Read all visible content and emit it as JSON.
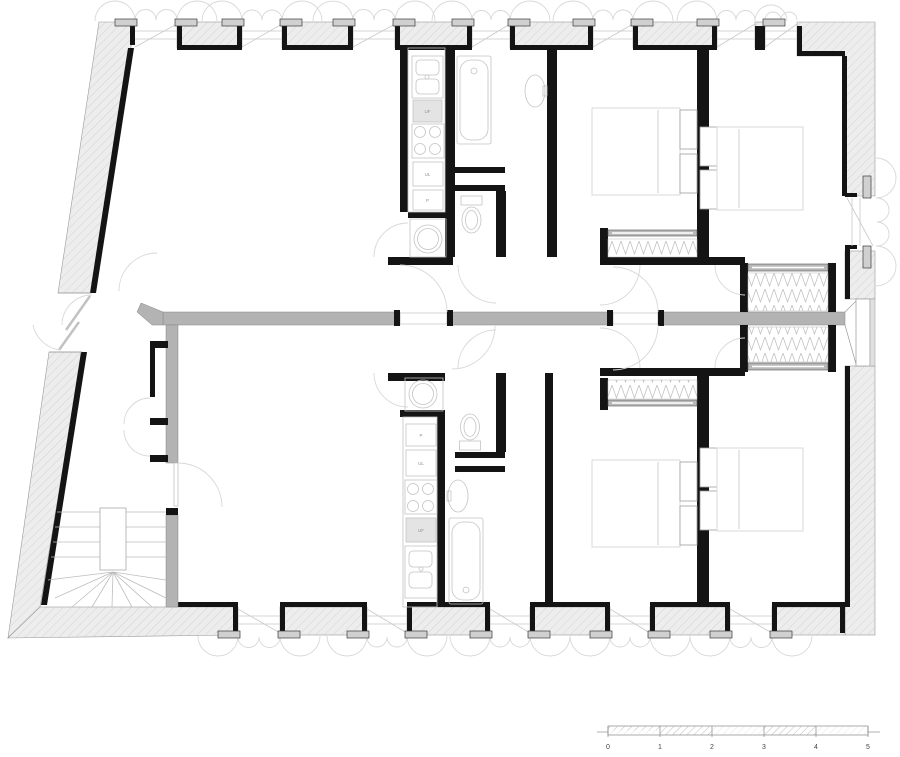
{
  "document": {
    "type": "architectural floor plan",
    "description": "Floor plan of a building level with two mirrored apartment units separated by a gray partition wall, each with open living room, galley kitchen, bathroom, WC and two bedrooms with beds and wardrobes; winder staircase at lower left, entrance door in the slanted left facade, windows with shutter swing arcs along top, bottom and right facades, metric scale bar at lower right."
  },
  "colors": {
    "structural_wall": "#141414",
    "new_partition_wall": "#b3b3b3",
    "exterior_wall_fill": "#ededed",
    "hatch_line": "#cdcdcd",
    "fixture_line": "#c4c4c4",
    "door_arc_line": "#d8d8d8",
    "appliance_fill": "#e4e4e4",
    "label_text": "#8f8f8f",
    "scale_text": "#444444"
  },
  "labels": {
    "kitchen_upper": [
      "UF",
      "UL",
      "P"
    ],
    "kitchen_lower": [
      "P",
      "UL",
      "UF"
    ]
  },
  "scale_bar": {
    "values": [
      "0",
      "1",
      "2",
      "3",
      "4",
      "5"
    ]
  }
}
